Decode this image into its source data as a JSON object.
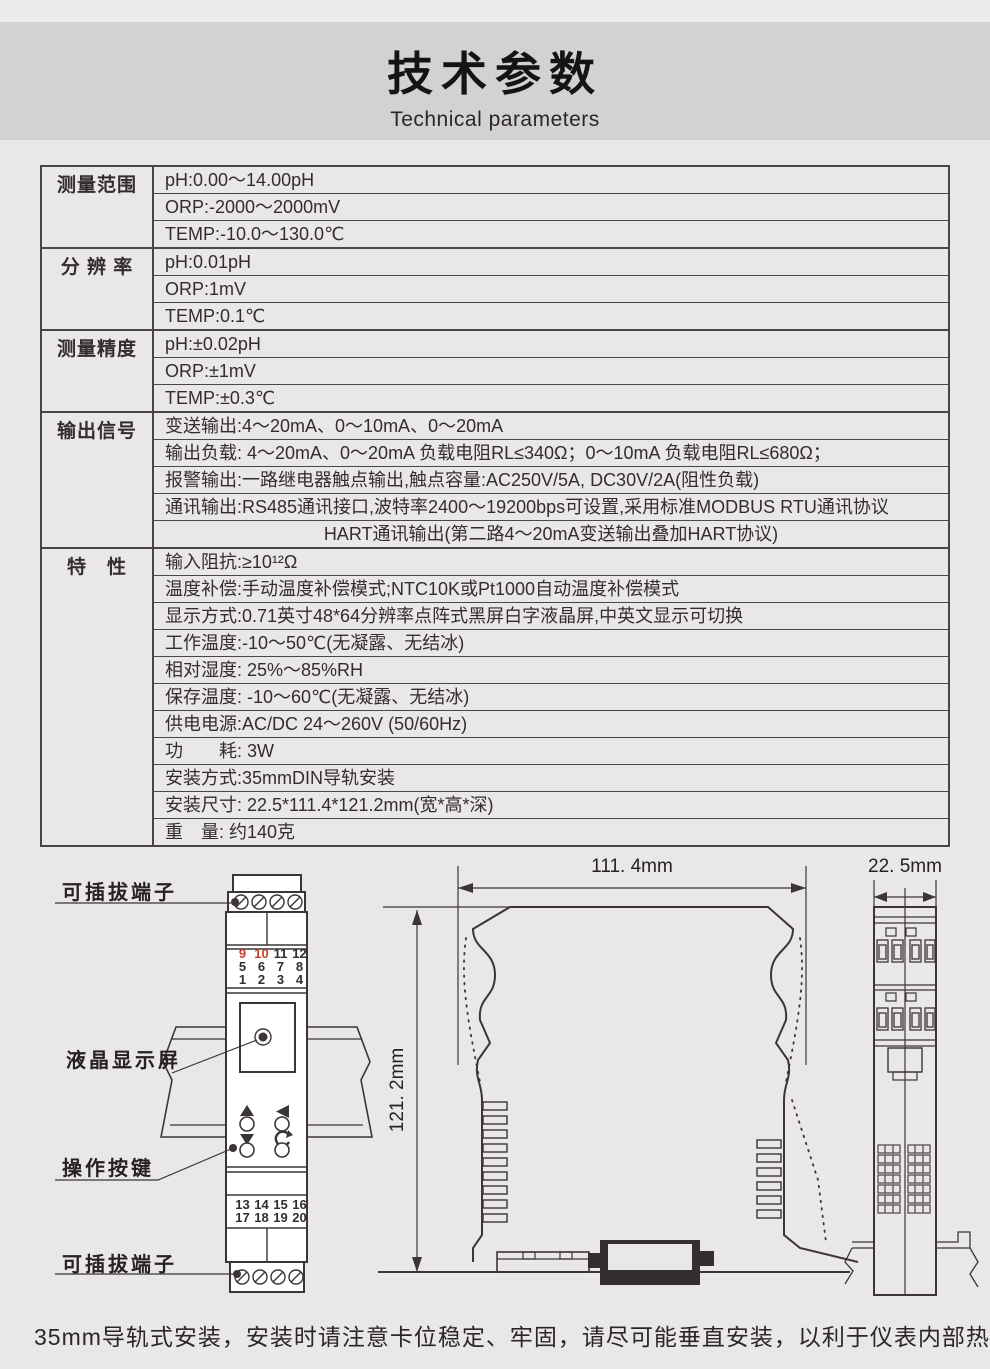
{
  "page": {
    "title": "技术参数",
    "subtitle": "Technical parameters",
    "footer_note": "35mm导轨式安装，安装时请注意卡位稳定、牢固，请尽可能垂直安装，以利于仪表内部热量散发。"
  },
  "colors": {
    "page_bg": "#e9e7e7",
    "banner_bg": "#d3d1d1",
    "line": "#3b3536",
    "red_accent": "#c4432f",
    "device_fill": "#ffffff",
    "clip_fill": "#332e2f"
  },
  "spec_table": {
    "groups": [
      {
        "label": "测量范围",
        "rows": [
          "pH:0.00～14.00pH",
          "ORP:-2000～2000mV",
          "TEMP:-10.0～130.0℃"
        ]
      },
      {
        "label": "分 辨 率",
        "rows": [
          "pH:0.01pH",
          "ORP:1mV",
          "TEMP:0.1℃"
        ]
      },
      {
        "label": "测量精度",
        "rows": [
          "pH:±0.02pH",
          "ORP:±1mV",
          "TEMP:±0.3℃"
        ]
      },
      {
        "label": "输出信号",
        "rows": [
          "变送输出:4～20mA、0～10mA、0～20mA",
          "输出负载: 4～20mA、0～20mA 负载电阻RL≤340Ω；0～10mA 负载电阻RL≤680Ω；",
          "报警输出:一路继电器触点输出,触点容量:AC250V/5A, DC30V/2A(阻性负载)",
          "通讯输出:RS485通讯接口,波特率2400～19200bps可设置,采用标准MODBUS RTU通讯协议",
          "HART通讯输出(第二路4～20mA变送输出叠加HART协议)"
        ]
      },
      {
        "label": "特　性",
        "rows": [
          "输入阻抗:≥10¹²Ω",
          "温度补偿:手动温度补偿模式;NTC10K或Pt1000自动温度补偿模式",
          "显示方式:0.71英寸48*64分辨率点阵式黑屏白字液晶屏,中英文显示可切换",
          "工作温度:-10～50℃(无凝露、无结冰)",
          "相对湿度: 25%～85%RH",
          "保存温度: -10～60℃(无凝露、无结冰)",
          "供电电源:AC/DC 24～260V (50/60Hz)",
          "功　　耗: 3W",
          "安装方式:35mmDIN导轨安装",
          "安装尺寸: 22.5*111.4*121.2mm(宽*高*深)",
          "重　量: 约140克"
        ]
      }
    ]
  },
  "diagram": {
    "labels": {
      "terminal_top": "可插拔端子",
      "lcd": "液晶显示屏",
      "keys": "操作按键",
      "terminal_bottom": "可插拔端子"
    },
    "dimensions": {
      "width": "111. 4mm",
      "depth": "121. 2mm",
      "side": "22. 5mm"
    },
    "front_view": {
      "terminal_numbers_top": [
        [
          "9",
          "10",
          "11",
          "12"
        ],
        [
          "5",
          "6",
          "7",
          "8"
        ],
        [
          "1",
          "2",
          "3",
          "4"
        ]
      ],
      "terminal_numbers_bottom": [
        [
          "13",
          "14",
          "15",
          "16"
        ],
        [
          "17",
          "18",
          "19",
          "20"
        ]
      ],
      "red_numbers": [
        "9",
        "10"
      ]
    }
  }
}
